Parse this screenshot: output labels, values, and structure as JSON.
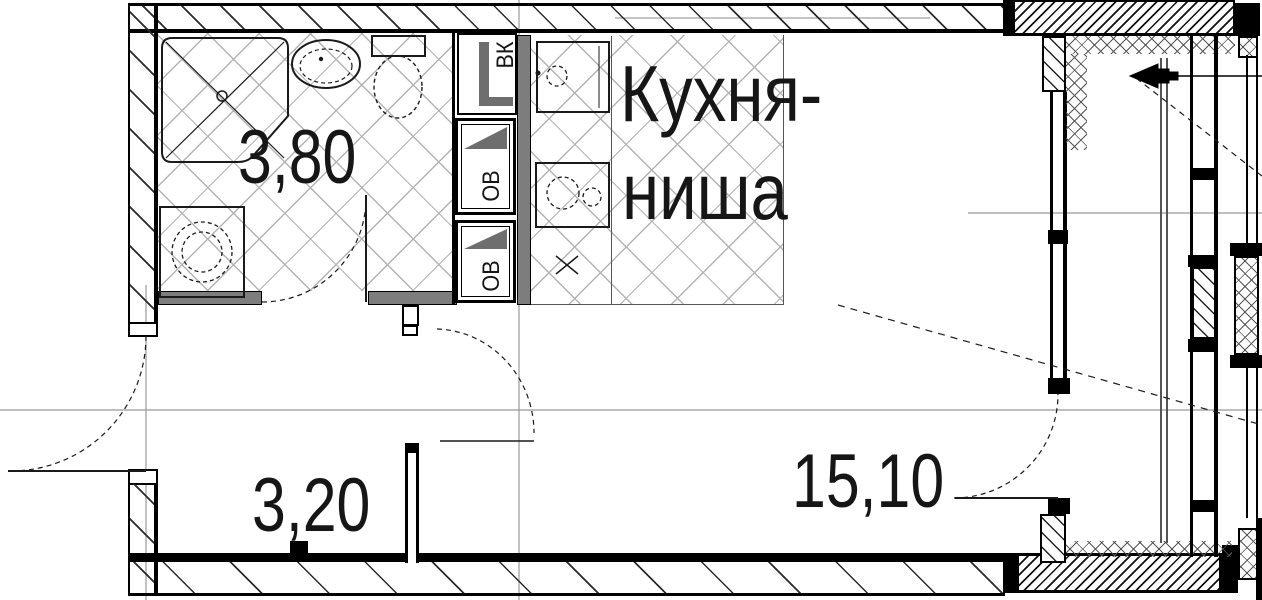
{
  "labels": {
    "bathroom_area": "3,80",
    "hallway_area": "3,20",
    "room_area": "15,10",
    "kitchen_name_line1": "Кухня-",
    "kitchen_name_line2": "ниша",
    "shaft_vk": "ВК",
    "shaft_ov_top": "ОВ",
    "shaft_ov_bottom": "ОВ"
  },
  "colors": {
    "background": "#ffffff",
    "wall_line": "#000000",
    "partition_fill": "#7d7d7d",
    "floor_hatch": "#b3b3b3",
    "axis_line": "#999999",
    "fixture_line": "#1a1a1a"
  }
}
